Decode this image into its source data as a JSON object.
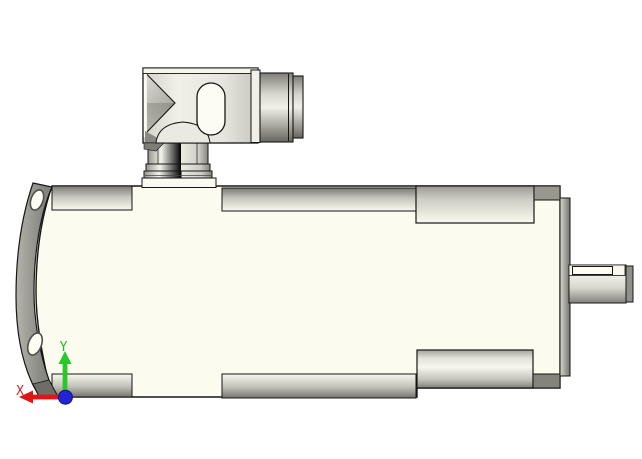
{
  "viewer": {
    "type": "3D CAD viewport",
    "subject": "servo motor with right-angle cable connector, side view",
    "background_top": "#00ffff",
    "background_bottom": "#c1c9cf",
    "body_color": "#fbfbf0",
    "outline_color": "#161616"
  },
  "triad": {
    "x_label": "X",
    "y_label": "Y",
    "x_color": "#e01616",
    "x_label_color": "#cc2626",
    "y_color": "#28c828",
    "y_label_color": "#2eb42e",
    "origin_color": "#2424d4"
  },
  "parts": {
    "flange": "mounting-flange",
    "flange_holes": "flange-bolt-holes",
    "housing": "motor-housing",
    "top_rail": "housing-top-chamfer",
    "bottom_rail": "housing-bottom-chamfer",
    "rear_block_top": "top-rear-boss",
    "rear_block_bottom": "bottom-rear-boss",
    "end_bell": "rear-end-bell",
    "shaft": "output-shaft",
    "keyway": "shaft-keyway",
    "connector_box": "right-angle-connector-body",
    "connector_neck": "connector-neck",
    "cable_gland": "cable-gland"
  }
}
